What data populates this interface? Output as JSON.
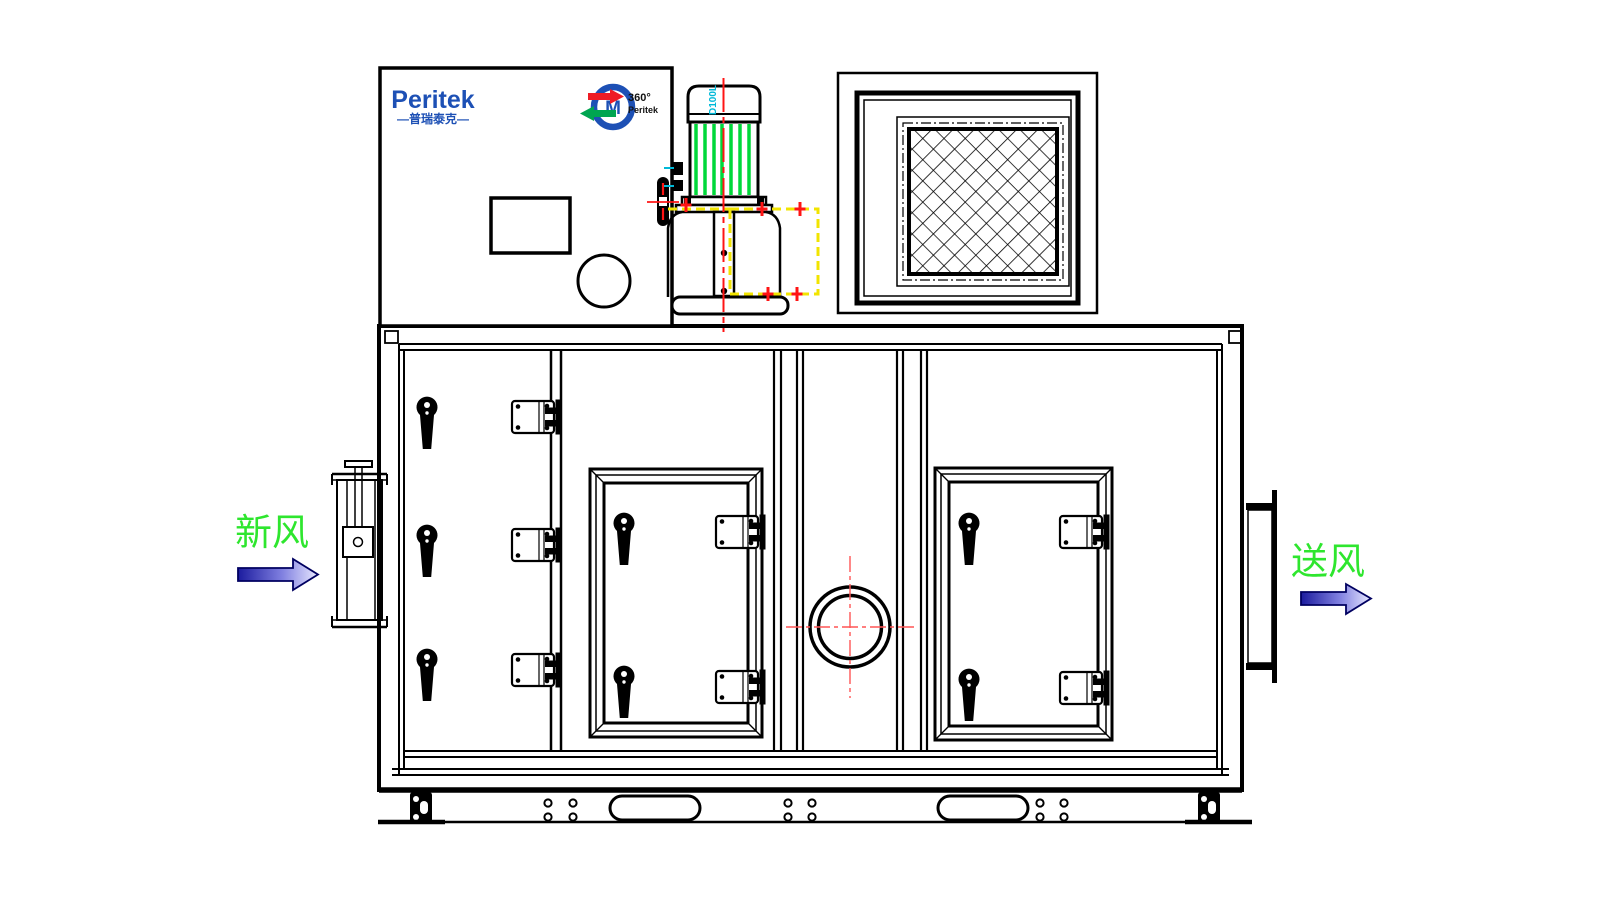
{
  "title": "Dehumidifier unit front elevation drawing",
  "brand": {
    "logo_text": "Peritek",
    "logo_subtext": "—普瑞泰克—",
    "rotor_logo": {
      "line1": "360°",
      "line2": "Peritek",
      "letter": "M"
    }
  },
  "motor": {
    "model_label": "D100L"
  },
  "labels": {
    "inlet": "新风",
    "outlet": "送风"
  },
  "colors": {
    "line_black": "#000000",
    "brand_blue": "#1d50b5",
    "logo_red": "#ee1c25",
    "logo_green": "#00a551",
    "motor_fin_green": "#00d83a",
    "flow_label_green": "#2ee62e",
    "centerline_red": "#ff1414",
    "crosshair_red": "#ff5555",
    "guard_yellow": "#f2e400",
    "model_label_cyan": "#00b9d8",
    "arrow_dark_blue": "#1b1b9e",
    "arrow_light_blue": "#e8e8ff"
  }
}
